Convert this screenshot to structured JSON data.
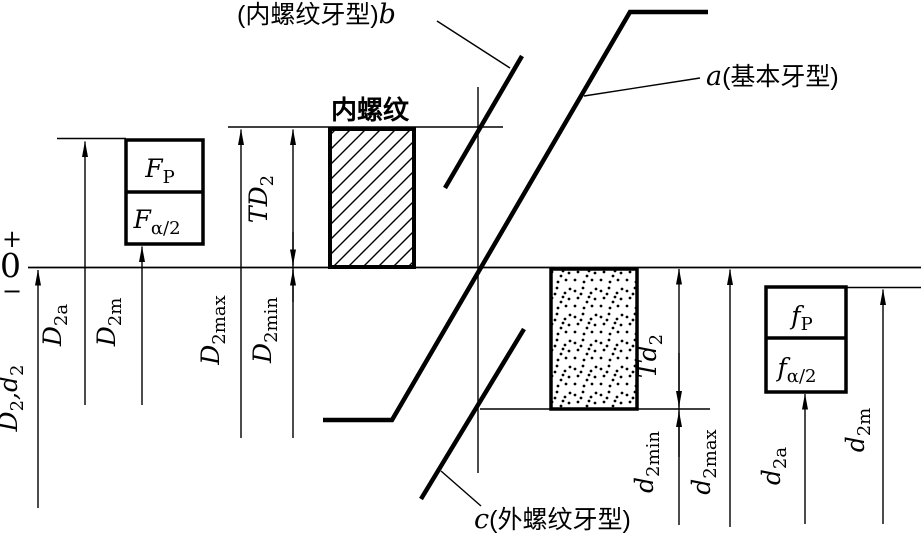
{
  "colors": {
    "ink": "#000000",
    "background": "#ffffff"
  },
  "callouts": {
    "internal_profile": {
      "cjk": "(内螺纹牙型)",
      "var": "b"
    },
    "basic_profile": {
      "var": "a",
      "cjk": "(基本牙型)"
    },
    "external_profile": {
      "var": "c",
      "cjk": "(外螺纹牙型)"
    },
    "internal_thread_zone": "内螺纹"
  },
  "axis": {
    "plus": "+",
    "zero": "0",
    "minus": "−"
  },
  "zones": {
    "FP": {
      "main": "F",
      "sub": "P"
    },
    "Fa2": {
      "main": "F",
      "sub": "α/2"
    },
    "fP": {
      "main": "f",
      "sub": "P"
    },
    "fa2": {
      "main": "f",
      "sub": "α/2"
    }
  },
  "dims": {
    "D2d2": {
      "p1": "D",
      "s1": "2",
      "p2": ",d",
      "s2": "2"
    },
    "D2a": {
      "main": "D",
      "sub": "2a"
    },
    "D2m": {
      "main": "D",
      "sub": "2m"
    },
    "D2max": {
      "main": "D",
      "sub": "2max"
    },
    "D2min": {
      "main": "D",
      "sub": "2min"
    },
    "TD2": {
      "main": "TD",
      "sub": "2"
    },
    "Td2": {
      "main": "Td",
      "sub": "2"
    },
    "d2min": {
      "main": "d",
      "sub": "2min"
    },
    "d2max": {
      "main": "d",
      "sub": "2max"
    },
    "d2a": {
      "main": "d",
      "sub": "2a"
    },
    "d2m": {
      "main": "d",
      "sub": "2m"
    }
  }
}
